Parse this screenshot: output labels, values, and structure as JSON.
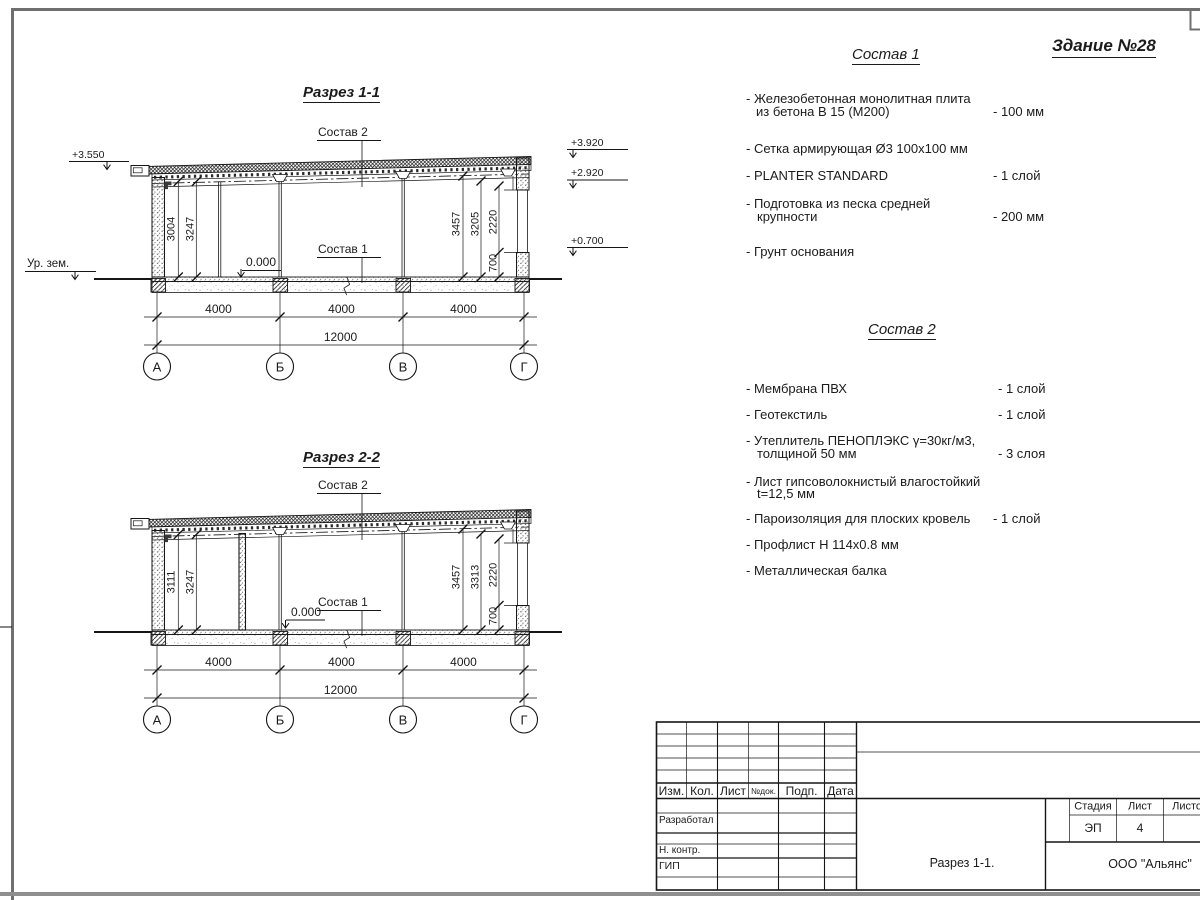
{
  "sheet": {
    "title": "Здание №28"
  },
  "sections": [
    {
      "title": "Разрез 1-1",
      "callout_top": "Состав 2",
      "callout_bottom": "Состав 1",
      "zero": "0.000",
      "elev_top_left": "+3.550",
      "ground": "Ур. зем.",
      "elev_right": [
        "+3.920",
        "+2.920",
        "+0.700"
      ],
      "dims_left": [
        "3004",
        "3247"
      ],
      "dims_right": [
        "3457",
        "3205",
        "2220",
        "700"
      ],
      "dims_bottom": [
        "4000",
        "4000",
        "4000"
      ],
      "dim_total": "12000",
      "axes": [
        "А",
        "Б",
        "В",
        "Г"
      ]
    },
    {
      "title": "Разрез 2-2",
      "callout_top": "Состав 2",
      "callout_bottom": "Состав 1",
      "zero": "0.000",
      "dims_left": [
        "3111",
        "3247"
      ],
      "dims_right": [
        "3457",
        "3313",
        "2220",
        "700"
      ],
      "dims_bottom": [
        "4000",
        "4000",
        "4000"
      ],
      "dim_total": "12000",
      "axes": [
        "А",
        "Б",
        "В",
        "Г"
      ]
    }
  ],
  "compositions": [
    {
      "title": "Состав 1",
      "items": [
        {
          "line1": "- Железобетонная  монолитная плита",
          "line2": "из бетона В 15 (М200)",
          "value": "- 100 мм"
        },
        {
          "line1": "- Сетка армирующая Ø3 100х100 мм",
          "line2": "",
          "value": ""
        },
        {
          "line1": "- PLANTER STANDARD",
          "line2": "",
          "value": "- 1  слой"
        },
        {
          "line1": "- Подготовка из песка средней",
          "line2": "крупности",
          "value": "- 200 мм"
        },
        {
          "line1": "- Грунт основания",
          "line2": "",
          "value": ""
        }
      ]
    },
    {
      "title": "Состав 2",
      "items": [
        {
          "line1": "- Мембрана ПВХ",
          "line2": "",
          "value": "- 1 слой"
        },
        {
          "line1": "- Геотекстиль",
          "line2": "",
          "value": "- 1 слой"
        },
        {
          "line1": "- Утеплитель ПЕНОПЛЭКС γ=30кг/м3,",
          "line2": "толщиной 50 мм",
          "value": "- 3 слоя"
        },
        {
          "line1": "- Лист гипсоволокнистый влагостойкий",
          "line2": "t=12,5 мм",
          "value": ""
        },
        {
          "line1": "- Пароизоляция для плоских кровель",
          "line2": "",
          "value": "- 1 слой"
        },
        {
          "line1": "- Профлист Н 114х0.8 мм",
          "line2": "",
          "value": ""
        },
        {
          "line1": "- Металлическая балка",
          "line2": "",
          "value": ""
        }
      ]
    }
  ],
  "titleblock": {
    "cols": [
      "Изм.",
      "Кол.",
      "Лист",
      "№док.",
      "Подп.",
      "Дата"
    ],
    "row_developed": "Разработал",
    "row_ncontr": "Н. контр.",
    "row_gip": "ГИП",
    "stage_label": "Стадия",
    "sheet_label": "Лист",
    "sheets_label": "Листов",
    "stage": "ЭП",
    "sheet_no": "4",
    "doc_title": "Разрез 1-1.",
    "company": "ООО \"Альянс\""
  }
}
